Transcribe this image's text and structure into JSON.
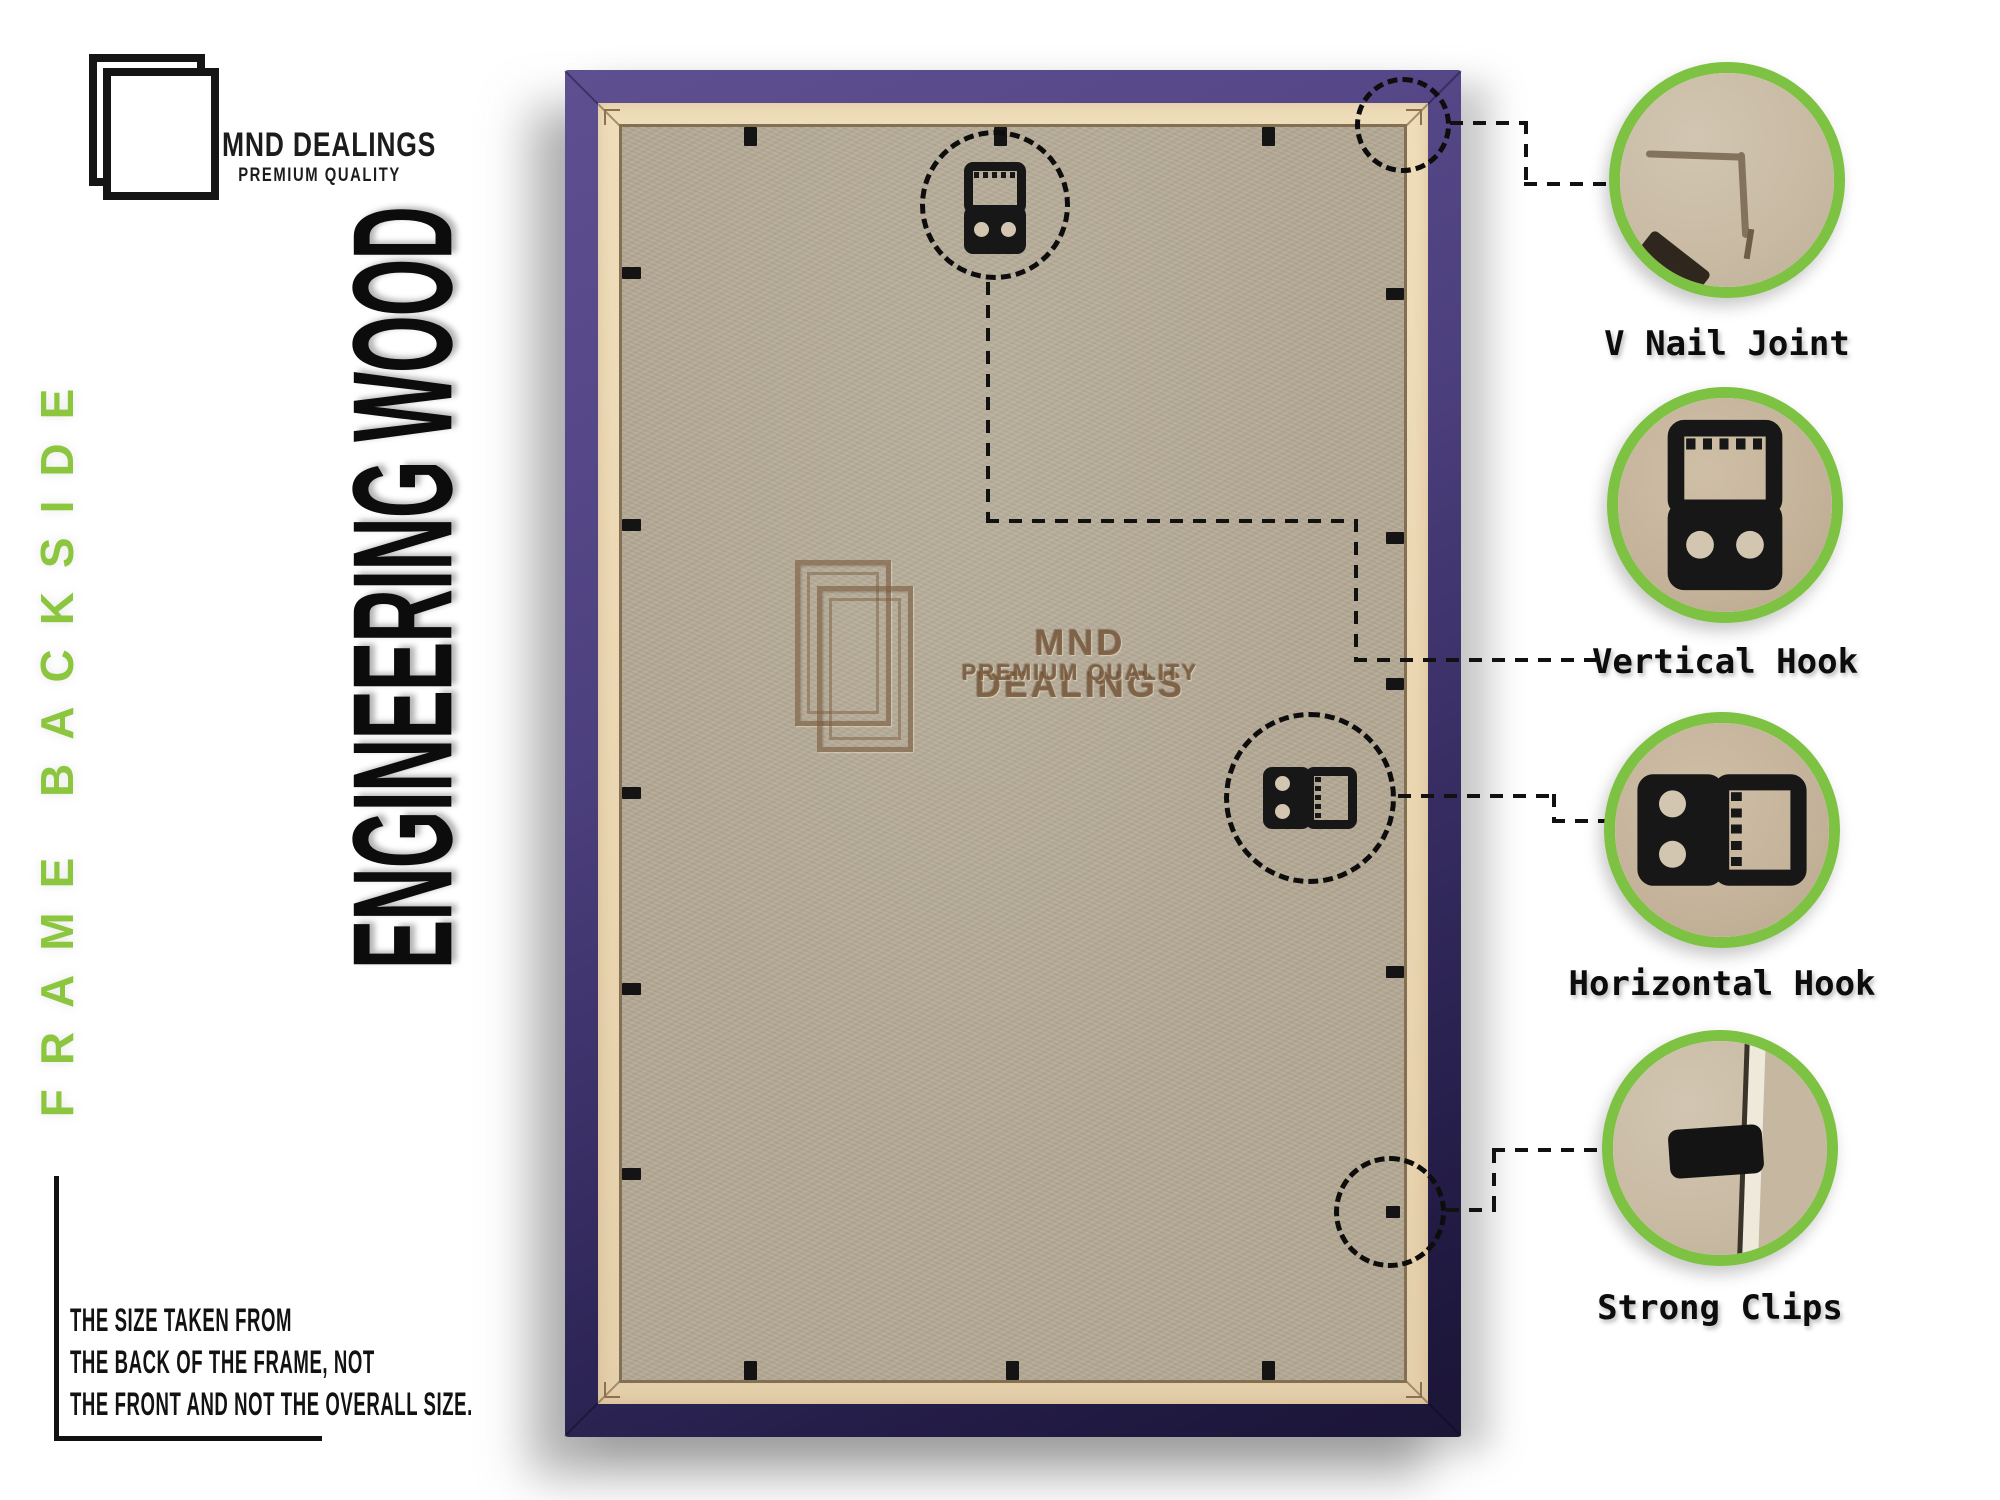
{
  "brand": {
    "name": "MND DEALINGS",
    "tagline": "PREMIUM QUALITY",
    "logo_icon": "double-frame-icon"
  },
  "side_label": "FRAME BACKSIDE",
  "material_label": "ENGINEERING WOOD",
  "watermark": {
    "name": "MND DEALINGS",
    "tagline": "PREMIUM QUALITY",
    "logo_icon": "double-frame-icon"
  },
  "size_note": {
    "line1": "THE SIZE TAKEN FROM",
    "line2": "THE BACK OF THE FRAME, NOT",
    "line3": "THE FRONT AND NOT THE OVERALL SIZE."
  },
  "callouts": [
    {
      "id": "v-nail-joint",
      "label": "V Nail Joint",
      "icon": "corner-joint-photo"
    },
    {
      "id": "vertical-hook",
      "label": "Vertical Hook",
      "icon": "vertical-hook-photo"
    },
    {
      "id": "horizontal-hook",
      "label": "Horizontal Hook",
      "icon": "horizontal-hook-photo"
    },
    {
      "id": "strong-clips",
      "label": "Strong Clips",
      "icon": "strong-clip-photo"
    }
  ],
  "colors": {
    "accent_green": "#7DC242",
    "label_green": "#8CC63F",
    "frame_purple": "#57497F",
    "frame_purple_dark": "#1E1838",
    "mat_cream": "#ECD9B4",
    "backing_tan": "#B4A995",
    "ink": "#111111"
  }
}
